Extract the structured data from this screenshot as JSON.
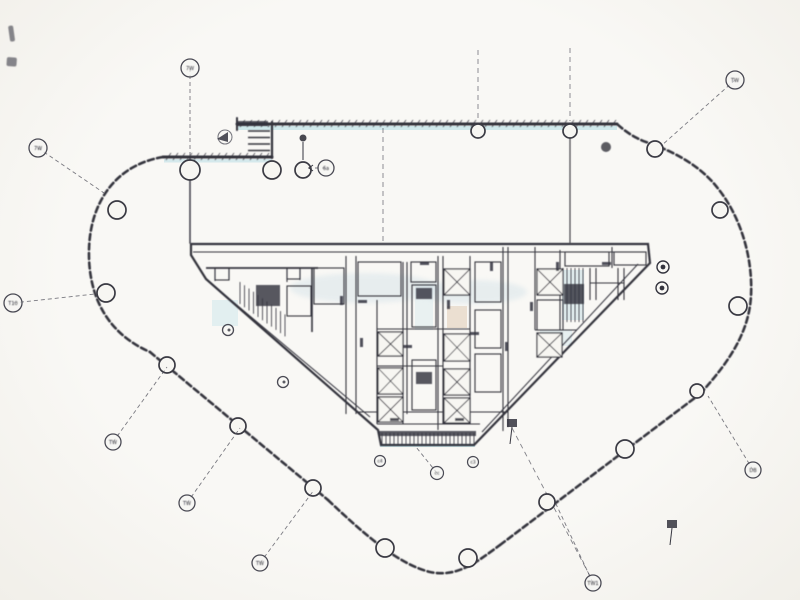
{
  "document": {
    "kind": "scanned architectural floor plan",
    "visible_title": "",
    "paper_color": "#f7f6f2",
    "ink_color": "#34343e",
    "light_ink_color": "#5a5a64",
    "cyan_tint_color": "#a8d8e2",
    "tan_tint_color": "#c9a57e"
  },
  "perimeter": [
    {
      "name": "top-left-wall",
      "path": "M163,157 L272,157",
      "width": 3,
      "hatch": {
        "x1": 166,
        "x2": 270,
        "y": 157
      }
    },
    {
      "name": "top-wall",
      "path": "M237,124 L617,124",
      "width": 3,
      "hatch": {
        "x1": 240,
        "x2": 615,
        "y": 124
      }
    },
    {
      "name": "louver-jamb-wall",
      "path": "M272,122 L272,158",
      "width": 2.2
    },
    {
      "name": "top-wall-end-cap",
      "path": "M237,118 L237,130",
      "width": 2
    },
    {
      "name": "left-arc-wall",
      "path": "M163,157 C115,165 90,203 89,250 C88,292 104,332 150,352",
      "width": 2.6,
      "dash": "6 3.5"
    },
    {
      "name": "lower-left-diagonal-wall",
      "path": "M150,352 L328,500",
      "width": 2.6,
      "dash": "6 3.5"
    },
    {
      "name": "bottom-curve-wall",
      "path": "M328,500 C365,535 398,564 430,572 C458,578 478,561 500,545",
      "width": 2.6,
      "dash": "6 3.5"
    },
    {
      "name": "lower-right-diagonal-wall",
      "path": "M500,545 L700,394",
      "width": 2.6,
      "dash": "6 3.5"
    },
    {
      "name": "right-arc-wall",
      "path": "M700,394 C731,360 749,331 751,296 C753,258 741,216 716,186 C699,165 673,151 646,142 C635,138 626,132 617,124",
      "width": 2.6,
      "dash": "6 3.5"
    },
    {
      "name": "wing-wall-left",
      "path": "M190,158 L190,243",
      "width": 1.4
    },
    {
      "name": "wing-wall-right",
      "path": "M570,126 L570,243",
      "width": 1.1
    }
  ],
  "louver_rungs": [
    {
      "x1": 248,
      "y1": 131,
      "x2": 270,
      "y2": 131
    },
    {
      "x1": 248,
      "y1": 137.5,
      "x2": 270,
      "y2": 137.5
    },
    {
      "x1": 248,
      "y1": 144,
      "x2": 270,
      "y2": 144
    },
    {
      "x1": 248,
      "y1": 150.5,
      "x2": 270,
      "y2": 150.5
    }
  ],
  "grid_lines": [
    {
      "x1": 383,
      "y1": 128,
      "x2": 383,
      "y2": 241
    },
    {
      "x1": 478,
      "y1": 50,
      "x2": 478,
      "y2": 121
    },
    {
      "x1": 570,
      "y1": 48,
      "x2": 570,
      "y2": 121
    },
    {
      "x1": 512,
      "y1": 428,
      "x2": 591,
      "y2": 578
    }
  ],
  "grid_bubbles": [
    {
      "x": 38,
      "y": 148,
      "r": 9,
      "label": "7W",
      "lx": 104,
      "ly": 193
    },
    {
      "x": 190,
      "y": 68,
      "r": 9,
      "label": "7W",
      "lx": 190,
      "ly": 159
    },
    {
      "x": 735,
      "y": 80,
      "r": 9,
      "label": "TW",
      "lx": 661,
      "ly": 146
    },
    {
      "x": 13,
      "y": 303,
      "r": 9,
      "label": "T10",
      "lx": 95,
      "ly": 294
    },
    {
      "x": 113,
      "y": 442,
      "r": 8,
      "label": "TW",
      "lx": 167,
      "ly": 367
    },
    {
      "x": 187,
      "y": 503,
      "r": 8,
      "label": "TW",
      "lx": 240,
      "ly": 428
    },
    {
      "x": 260,
      "y": 563,
      "r": 8,
      "label": "TW",
      "lx": 314,
      "ly": 490
    },
    {
      "x": 593,
      "y": 583,
      "r": 8,
      "label": "TW1",
      "lx": 556,
      "ly": 504
    },
    {
      "x": 753,
      "y": 470,
      "r": 8,
      "label": "DB",
      "lx": 708,
      "ly": 396
    },
    {
      "x": 326,
      "y": 168,
      "r": 8,
      "label": "6a",
      "lx": 306,
      "ly": 168
    }
  ],
  "column_markers": [
    {
      "x": 190,
      "y": 170,
      "r": 10
    },
    {
      "x": 272,
      "y": 170,
      "r": 9
    },
    {
      "x": 303,
      "y": 170,
      "r": 8
    },
    {
      "x": 478,
      "y": 131,
      "r": 7
    },
    {
      "x": 570,
      "y": 131,
      "r": 7
    },
    {
      "x": 117,
      "y": 210,
      "r": 9
    },
    {
      "x": 106,
      "y": 293,
      "r": 9
    },
    {
      "x": 167,
      "y": 365,
      "r": 8
    },
    {
      "x": 238,
      "y": 426,
      "r": 8
    },
    {
      "x": 313,
      "y": 488,
      "r": 8
    },
    {
      "x": 385,
      "y": 548,
      "r": 9
    },
    {
      "x": 468,
      "y": 558,
      "r": 9
    },
    {
      "x": 547,
      "y": 502,
      "r": 8
    },
    {
      "x": 625,
      "y": 449,
      "r": 9
    },
    {
      "x": 697,
      "y": 391,
      "r": 7
    },
    {
      "x": 655,
      "y": 149,
      "r": 8
    },
    {
      "x": 720,
      "y": 210,
      "r": 8
    },
    {
      "x": 738,
      "y": 306,
      "r": 9
    }
  ],
  "tags": [
    {
      "type": "section",
      "x": 225,
      "y": 137,
      "label": ""
    },
    {
      "type": "dotstem",
      "x": 303,
      "y": 138,
      "label": ""
    },
    {
      "type": "blob",
      "x": 606,
      "y": 147,
      "r": 5,
      "label": ""
    },
    {
      "type": "ringdot",
      "x": 663,
      "y": 267,
      "label": ""
    },
    {
      "type": "ringdot",
      "x": 662,
      "y": 288,
      "label": ""
    },
    {
      "type": "hollow",
      "x": 228,
      "y": 330,
      "r": 5.5,
      "label": ""
    },
    {
      "type": "hollow",
      "x": 283,
      "y": 382,
      "r": 5.5,
      "label": ""
    },
    {
      "type": "labeled",
      "x": 380,
      "y": 461,
      "r": 5.5,
      "label": "c4"
    },
    {
      "type": "labeled",
      "x": 437,
      "y": 473,
      "r": 6.5,
      "label": "cc",
      "lx": 416,
      "ly": 447
    },
    {
      "type": "labeled",
      "x": 473,
      "y": 462,
      "r": 5.5,
      "label": "c3"
    },
    {
      "type": "flag",
      "x": 512,
      "y": 424,
      "label": ""
    },
    {
      "type": "flag",
      "x": 672,
      "y": 525,
      "label": ""
    }
  ],
  "core": {
    "outline": "M191,244 L648,244 L650,263 L474,445 L381,445 L378,430 L206,279 L191,255 Z",
    "outline_width": 2.2,
    "inner_diagonals": [
      {
        "x1": 213,
        "y1": 285,
        "x2": 370,
        "y2": 417
      },
      {
        "x1": 638,
        "y1": 264,
        "x2": 482,
        "y2": 432
      }
    ],
    "partitions": [
      {
        "x1": 193,
        "y1": 252,
        "x2": 646,
        "y2": 252
      },
      {
        "x1": 206,
        "y1": 268,
        "x2": 318,
        "y2": 268,
        "w": 1.8
      },
      {
        "x1": 215,
        "y1": 268,
        "x2": 215,
        "y2": 281
      },
      {
        "x1": 229,
        "y1": 268,
        "x2": 229,
        "y2": 280
      },
      {
        "x1": 287,
        "y1": 268,
        "x2": 287,
        "y2": 282
      },
      {
        "x1": 300,
        "y1": 268,
        "x2": 300,
        "y2": 280
      },
      {
        "x1": 312,
        "y1": 268,
        "x2": 312,
        "y2": 332,
        "w": 1.6
      },
      {
        "x1": 346,
        "y1": 256,
        "x2": 346,
        "y2": 414
      },
      {
        "x1": 356,
        "y1": 256,
        "x2": 356,
        "y2": 414
      },
      {
        "x1": 377,
        "y1": 300,
        "x2": 377,
        "y2": 424
      },
      {
        "x1": 403,
        "y1": 262,
        "x2": 403,
        "y2": 424
      },
      {
        "x1": 407,
        "y1": 262,
        "x2": 407,
        "y2": 414
      },
      {
        "x1": 438,
        "y1": 256,
        "x2": 438,
        "y2": 430
      },
      {
        "x1": 443,
        "y1": 256,
        "x2": 443,
        "y2": 424
      },
      {
        "x1": 470,
        "y1": 256,
        "x2": 470,
        "y2": 424
      },
      {
        "x1": 503,
        "y1": 247,
        "x2": 503,
        "y2": 431
      },
      {
        "x1": 508,
        "y1": 247,
        "x2": 508,
        "y2": 427
      },
      {
        "x1": 535,
        "y1": 247,
        "x2": 535,
        "y2": 330
      },
      {
        "x1": 560,
        "y1": 250,
        "x2": 560,
        "y2": 330
      },
      {
        "x1": 590,
        "y1": 268,
        "x2": 590,
        "y2": 300
      },
      {
        "x1": 596,
        "y1": 268,
        "x2": 596,
        "y2": 300
      },
      {
        "x1": 618,
        "y1": 268,
        "x2": 618,
        "y2": 300
      },
      {
        "x1": 624,
        "y1": 268,
        "x2": 624,
        "y2": 300
      },
      {
        "x1": 590,
        "y1": 283,
        "x2": 624,
        "y2": 283
      },
      {
        "x1": 612,
        "y1": 247,
        "x2": 612,
        "y2": 268
      },
      {
        "x1": 377,
        "y1": 329,
        "x2": 470,
        "y2": 329
      },
      {
        "x1": 377,
        "y1": 366,
        "x2": 443,
        "y2": 366
      },
      {
        "x1": 356,
        "y1": 412,
        "x2": 508,
        "y2": 412
      },
      {
        "x1": 377,
        "y1": 424,
        "x2": 480,
        "y2": 424
      },
      {
        "x1": 535,
        "y1": 330,
        "x2": 577,
        "y2": 330
      }
    ],
    "rooms": [
      {
        "x": 215,
        "y": 268,
        "w": 14,
        "h": 12
      },
      {
        "x": 287,
        "y": 268,
        "w": 13,
        "h": 11
      },
      {
        "x": 287,
        "y": 286,
        "w": 24,
        "h": 30
      },
      {
        "x": 314,
        "y": 268,
        "w": 30,
        "h": 36
      },
      {
        "x": 358,
        "y": 262,
        "w": 43,
        "h": 34
      },
      {
        "x": 411,
        "y": 262,
        "w": 25,
        "h": 20
      },
      {
        "x": 412,
        "y": 285,
        "w": 24,
        "h": 42
      },
      {
        "x": 412,
        "y": 360,
        "w": 24,
        "h": 50
      },
      {
        "x": 475,
        "y": 262,
        "w": 26,
        "h": 40
      },
      {
        "x": 475,
        "y": 310,
        "w": 26,
        "h": 38
      },
      {
        "x": 475,
        "y": 354,
        "w": 26,
        "h": 38
      },
      {
        "x": 537,
        "y": 300,
        "w": 26,
        "h": 30
      },
      {
        "x": 565,
        "y": 252,
        "w": 44,
        "h": 14
      },
      {
        "x": 614,
        "y": 252,
        "w": 32,
        "h": 13
      }
    ],
    "shafts": [
      {
        "x": 378,
        "y": 332,
        "w": 25,
        "h": 24
      },
      {
        "x": 378,
        "y": 368,
        "w": 25,
        "h": 26
      },
      {
        "x": 378,
        "y": 397,
        "w": 25,
        "h": 25
      },
      {
        "x": 444,
        "y": 269,
        "w": 26,
        "h": 26
      },
      {
        "x": 444,
        "y": 334,
        "w": 26,
        "h": 27
      },
      {
        "x": 444,
        "y": 369,
        "w": 26,
        "h": 26
      },
      {
        "x": 444,
        "y": 398,
        "w": 26,
        "h": 25
      },
      {
        "x": 537,
        "y": 269,
        "w": 26,
        "h": 26
      },
      {
        "x": 537,
        "y": 333,
        "w": 25,
        "h": 24
      }
    ],
    "stairs": [
      {
        "x": 240,
        "y": 282,
        "w": 45,
        "h": 22,
        "dir": "skew"
      },
      {
        "x": 562,
        "y": 268,
        "w": 24,
        "h": 54,
        "dir": "v"
      },
      {
        "x": 381,
        "y": 433,
        "w": 93,
        "h": 13,
        "dir": "v"
      }
    ],
    "dark_blocks": [
      {
        "x": 256,
        "y": 285,
        "w": 24,
        "h": 21
      },
      {
        "x": 564,
        "y": 284,
        "w": 20,
        "h": 20
      },
      {
        "x": 416,
        "y": 288,
        "w": 16,
        "h": 11
      },
      {
        "x": 416,
        "y": 372,
        "w": 16,
        "h": 12
      },
      {
        "x": 379,
        "y": 431,
        "w": 97,
        "h": 5
      },
      {
        "x": 237,
        "y": 121,
        "w": 31,
        "h": 5
      }
    ],
    "door_ticks": [
      {
        "x": 340,
        "y": 296,
        "w": 3,
        "h": 9
      },
      {
        "x": 360,
        "y": 338,
        "w": 3,
        "h": 9
      },
      {
        "x": 420,
        "y": 262,
        "w": 9,
        "h": 3
      },
      {
        "x": 447,
        "y": 300,
        "w": 3,
        "h": 9
      },
      {
        "x": 470,
        "y": 332,
        "w": 9,
        "h": 3
      },
      {
        "x": 490,
        "y": 262,
        "w": 3,
        "h": 9
      },
      {
        "x": 505,
        "y": 342,
        "w": 3,
        "h": 9
      },
      {
        "x": 530,
        "y": 302,
        "w": 3,
        "h": 9
      },
      {
        "x": 556,
        "y": 262,
        "w": 3,
        "h": 9
      },
      {
        "x": 602,
        "y": 262,
        "w": 9,
        "h": 3
      },
      {
        "x": 390,
        "y": 418,
        "w": 9,
        "h": 3
      },
      {
        "x": 455,
        "y": 418,
        "w": 9,
        "h": 3
      },
      {
        "x": 358,
        "y": 300,
        "w": 9,
        "h": 3
      },
      {
        "x": 403,
        "y": 345,
        "w": 9,
        "h": 3
      }
    ]
  },
  "tints": [
    {
      "x": 238,
      "y": 126,
      "w": 379,
      "h": 4,
      "c": "cyan",
      "o": 0.5
    },
    {
      "x": 164,
      "y": 159,
      "w": 108,
      "h": 3.5,
      "c": "cyan",
      "o": 0.45
    },
    {
      "x": 380,
      "y": 444,
      "w": 95,
      "h": 3,
      "c": "cyan",
      "o": 0.55
    },
    {
      "x": 562,
      "y": 270,
      "w": 22,
      "h": 50,
      "c": "cyan",
      "o": 0.3
    },
    {
      "x": 212,
      "y": 300,
      "w": 26,
      "h": 26,
      "c": "cyan",
      "o": 0.28
    },
    {
      "x": 415,
      "y": 284,
      "w": 18,
      "h": 46,
      "c": "cyan",
      "o": 0.2
    },
    {
      "x": 540,
      "y": 330,
      "w": 32,
      "h": 16,
      "c": "cyan",
      "o": 0.22
    },
    {
      "x": 447,
      "y": 306,
      "w": 20,
      "h": 22,
      "c": "tan",
      "o": 0.3
    },
    {
      "x": 447,
      "y": 372,
      "w": 20,
      "h": 20,
      "c": "tan",
      "o": 0.28
    },
    {
      "x": 380,
      "y": 338,
      "w": 20,
      "h": 16,
      "c": "tan",
      "o": 0.2
    }
  ],
  "watermark_blobs": [
    {
      "cx": 365,
      "cy": 288,
      "rx": 75,
      "ry": 15
    },
    {
      "cx": 472,
      "cy": 292,
      "rx": 55,
      "ry": 12
    }
  ],
  "smudges": [
    {
      "x": 8,
      "y": 26,
      "w": 5,
      "h": 16,
      "rot": -8
    },
    {
      "x": 7,
      "y": 57,
      "w": 10,
      "h": 9,
      "rot": 4
    }
  ]
}
